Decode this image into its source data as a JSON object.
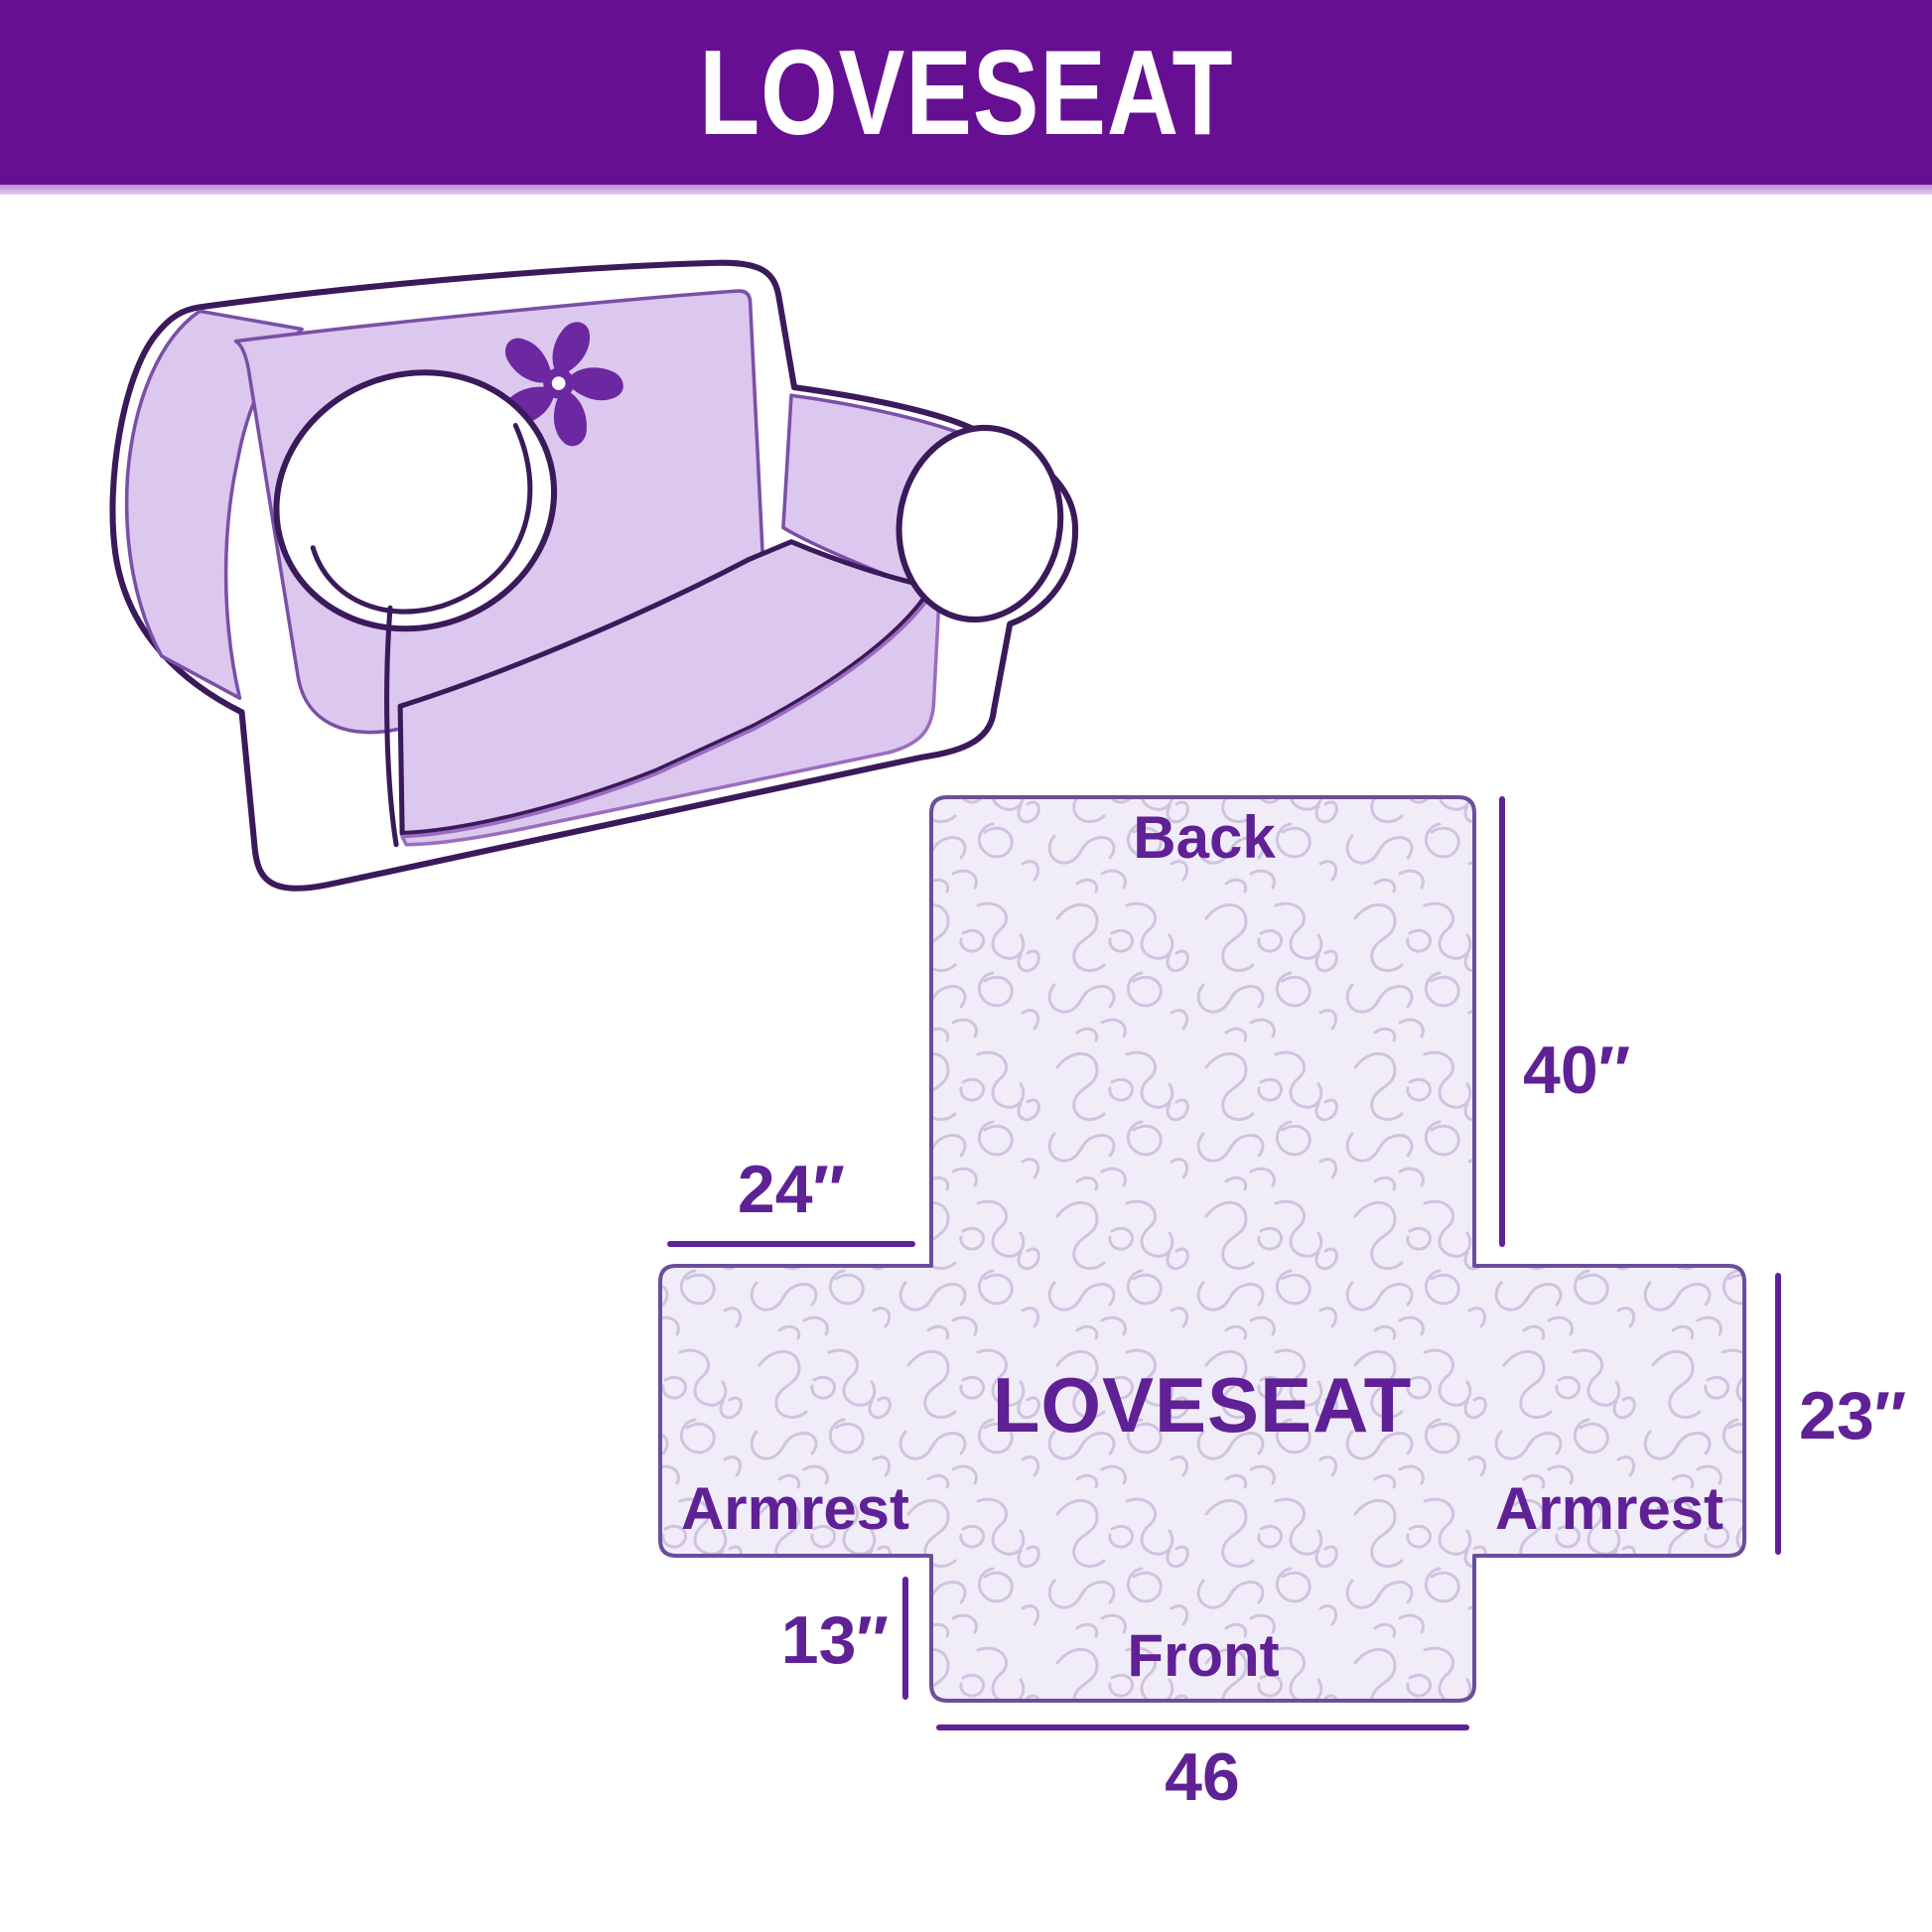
{
  "header": {
    "title": "LOVESEAT"
  },
  "diagram": {
    "center_label": "LOVESEAT",
    "back_label": "Back",
    "front_label": "Front",
    "armrest_left_label": "Armrest",
    "armrest_right_label": "Armrest",
    "dim_back_height": "40″",
    "dim_back_width": "24″",
    "dim_armrest_height": "23″",
    "dim_front_height": "13″",
    "dim_front_width": "46"
  },
  "icons": {
    "sofa_logo": "pinwheel-icon"
  },
  "colors": {
    "header_bg": "#660F93",
    "accent_text": "#5F2195",
    "cover_fill": "#DCC7EE",
    "sofa_outline": "#3A1A5B",
    "pattern_bg": "#F1EDF8",
    "pattern_line": "#CFC4E0",
    "diagram_border": "#6B4E9B",
    "pinwheel": "#6B28A0"
  }
}
